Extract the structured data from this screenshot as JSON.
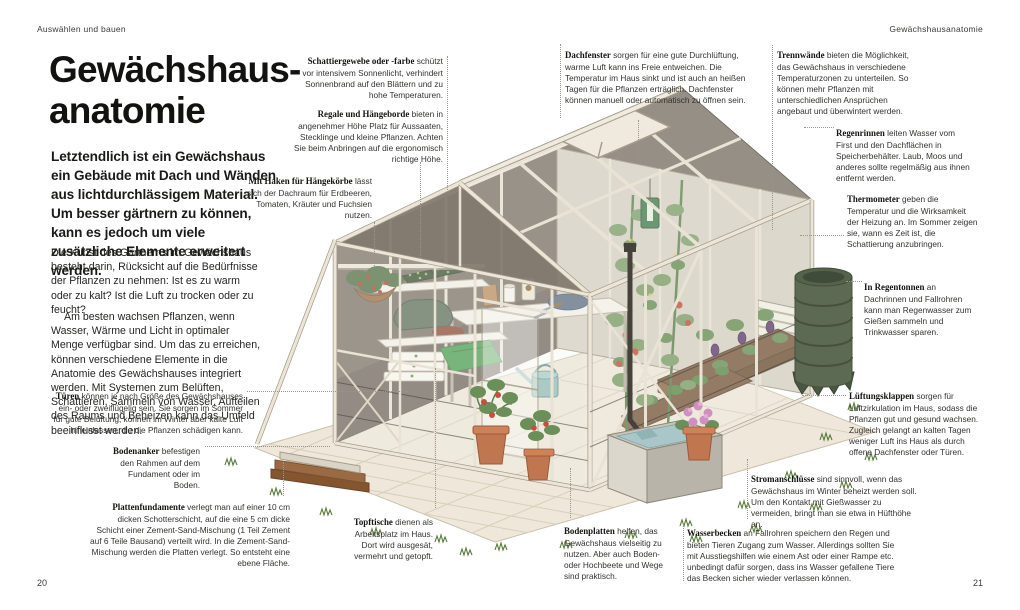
{
  "page": {
    "section_header": "Auswählen und bauen",
    "chapter_header": "Gewächshausanatomie",
    "page_number_left": "20",
    "page_number_right": "21"
  },
  "article": {
    "title_line_1": "Gewächshaus-",
    "title_line_2": "anatomie",
    "intro": "Letztendlich ist ein Gewächshaus ein Gebäude mit Dach und Wänden aus lichtdurchlässigem Material. Um besser gärtnern zu können, kann es jedoch um viele zusätzliche Elemente erweitert werden.",
    "body_paragraph_1": "Die Kunst des Gärtnerns im Gewächshaus besteht darin, Rücksicht auf die Bedürfnisse der Pflanzen zu nehmen: Ist es zu warm oder zu kalt? Ist die Luft zu trocken oder zu feucht?",
    "body_paragraph_2": "Am besten wachsen Pflanzen, wenn Wasser, Wärme und Licht in optimaler Menge verfügbar sind. Um das zu erreichen, können verschiedene Elemente in die Anatomie des Gewächshauses integriert werden. Mit Systemen zum Belüften, Schattieren, Sammeln von Wasser, Aufteilen des Raums und Beheizen kann das Umfeld beeinflusst werden."
  },
  "labels": {
    "schattiergewebe": {
      "lead": "Schattiergewebe oder -farbe",
      "rest": "schützt vor intensivem Sonnenlicht, verhindert Sonnenbrand auf den Blättern und zu hohe Temperaturen."
    },
    "regale": {
      "lead": "Regale und Hängeborde",
      "rest": "bieten in angenehmer Höhe Platz für Aussaaten, Stecklinge und kleine Pflanzen. Achten Sie beim Anbringen auf die ergonomisch richtige Höhe."
    },
    "haken": {
      "lead": "Mit Haken für Hängekörbe",
      "rest": "lässt sich der Dachraum für Erdbeeren, Tomaten, Kräuter und Fuchsien nutzen."
    },
    "tueren": {
      "lead": "Türen",
      "rest": "können je nach Größe des Gewächshauses ein- oder zweiflügelig sein. Sie sorgen im Sommer für gute Belüftung, können im Winter aber kalte Luft hineinlassen, die die Pflanzen schädigen kann."
    },
    "bodenanker": {
      "lead": "Bodenanker",
      "rest": "befestigen den Rahmen auf dem Fundament oder im Boden."
    },
    "plattenfundamente": {
      "lead": "Plattenfundamente",
      "rest": "verlegt man auf einer 10 cm dicken Schotterschicht, auf die eine 5 cm dicke Schicht einer Zement-Sand-Mischung (1 Teil Zement auf 6 Teile Bausand) verteilt wird. In die Zement-Sand-Mischung werden die Platten verlegt. So entsteht eine ebene Fläche."
    },
    "topftische": {
      "lead": "Topftische",
      "rest": "dienen als Arbeitsplatz im Haus. Dort wird ausgesät, vermehrt und getopft."
    },
    "dachfenster": {
      "lead": "Dachfenster",
      "rest": "sorgen für eine gute Durchlüftung, warme Luft kann ins Freie entweichen. Die Temperatur im Haus sinkt und ist auch an heißen Tagen für die Pflanzen erträglich. Dachfenster können manuell oder automatisch zu öffnen sein."
    },
    "trennwaende": {
      "lead": "Trennwände",
      "rest": "bieten die Möglichkeit, das Gewächshaus in verschiedene Temperaturzonen zu unterteilen. So können mehr Pflanzen mit unterschiedlichen Ansprüchen angebaut und überwintert werden."
    },
    "regenrinnen": {
      "lead": "Regenrinnen",
      "rest": "leiten Wasser vom First und den Dachflächen in Speicherbehälter. Laub, Moos und anderes sollte regelmäßig aus ihnen entfernt werden."
    },
    "thermometer": {
      "lead": "Thermometer",
      "rest": "geben die Temperatur und die Wirksamkeit der Heizung an. Im Sommer zeigen sie, wann es Zeit ist, die Schattierung anzubringen."
    },
    "regentonnen": {
      "lead": "In Regentonnen",
      "rest": "an Dachrinnen und Fallrohren kann man Regenwasser zum Gießen sammeln und Trinkwasser sparen."
    },
    "lueftungsklappen": {
      "lead": "Lüftungsklappen",
      "rest": "sorgen für Luftzirkulation im Haus, sodass die Pflanzen gut und gesund wachsen. Zugleich gelangt an kalten Tagen weniger Luft ins Haus als durch offene Dachfenster oder Türen."
    },
    "stromanschluesse": {
      "lead": "Stromanschlüsse",
      "rest": "sind sinnvoll, wenn das Gewächshaus im Winter beheizt werden soll. Um den Kontakt mit Gießwasser zu vermeiden, bringt man sie etwa in Hüfthöhe an."
    },
    "wasserbecken": {
      "lead": "Wasserbecken",
      "rest": "an Fallrohren speichern den Regen und bieten Tieren Zugang zum Wasser. Allerdings sollten Sie mit Ausstiegshilfen wie einem Ast oder einer Rampe etc. unbedingt dafür sorgen, dass ins Wasser gefallene Tiere das Becken sicher wieder verlassen können."
    },
    "bodenplatten": {
      "lead": "Bodenplatten",
      "rest": "helfen, das Gewächshaus vielseitig zu nutzen. Aber auch Boden- oder Hochbeete und Wege sind praktisch."
    }
  },
  "illustration": {
    "subject": "Isometrische Schnittzeichnung eines Gewächshauses",
    "components": [
      "greenhouse-frame",
      "glass-roof",
      "roof-window",
      "shading-wall",
      "partition-wall",
      "louver-vent",
      "hanging-basket",
      "shelves",
      "seedling-trays",
      "work-table",
      "watering-can",
      "thermometer",
      "tomato-plants",
      "raised-beds",
      "terracotta-pots",
      "rain-barrel",
      "downpipe",
      "water-basin",
      "wooden-ramp",
      "floor-tiles",
      "grass-tufts"
    ],
    "colors": {
      "frame_cream": "#ece6d8",
      "wall_dark_taupe": "#7b7268",
      "glass_tint": "#f2f0e9",
      "foliage_green": "#7d9d69",
      "tomato_red": "#c2503c",
      "terracotta": "#c0764f",
      "barrel_green": "#5c6a53",
      "water_blue": "#a9c6c8",
      "ramp_wood": "#9a6a44",
      "tile_beige": "#efe8da",
      "soil_brown": "#7a5a40",
      "flower_pink": "#cf8fc0"
    }
  }
}
